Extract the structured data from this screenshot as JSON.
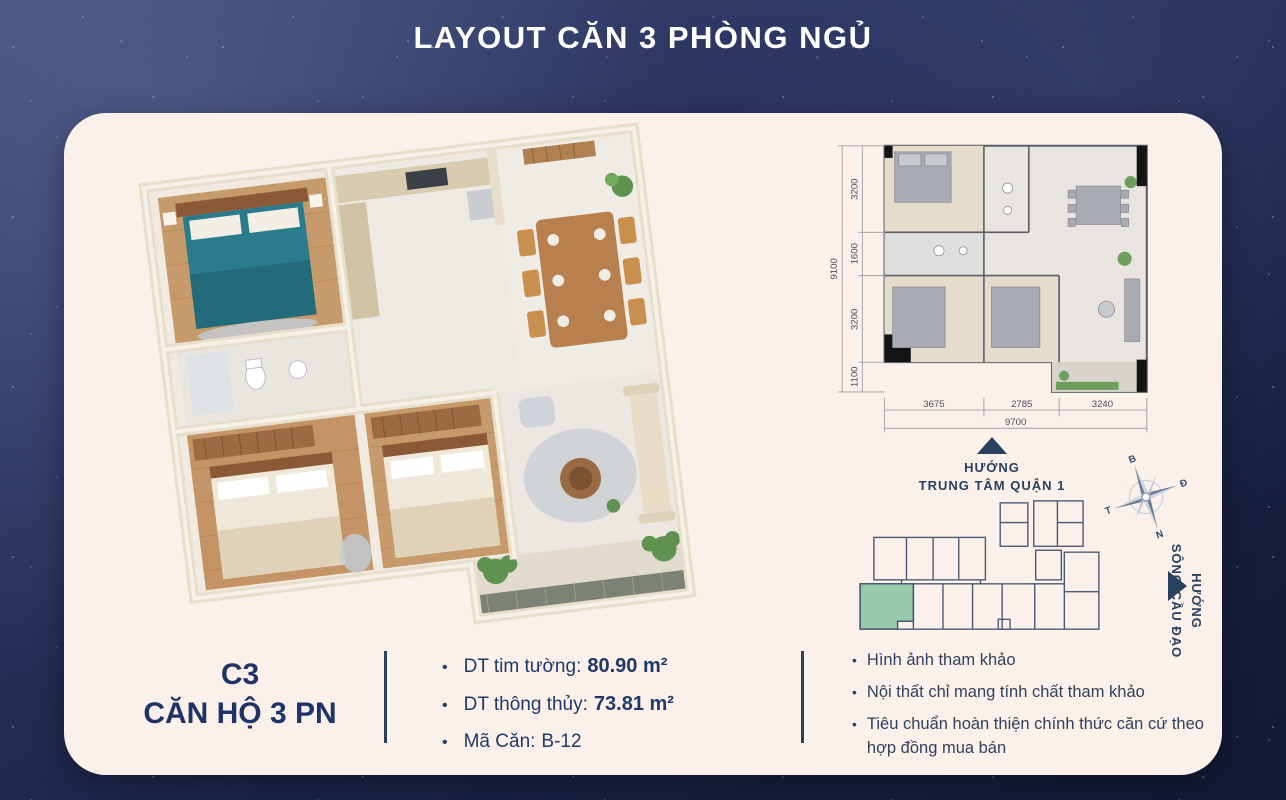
{
  "title": "LAYOUT CĂN 3 PHÒNG NGỦ",
  "unit": {
    "code": "C3",
    "name": "CĂN HỘ 3 PN"
  },
  "specs": [
    {
      "label": "DT tim tường:",
      "value": "80.90 m²"
    },
    {
      "label": "DT thông thủy:",
      "value": "73.81 m²"
    },
    {
      "label": "Mã Căn:",
      "value": "B-12"
    }
  ],
  "notes": [
    "Hình ảnh tham khảo",
    "Nội thất chỉ mang tính chất tham khảo",
    "Tiêu chuẩn hoàn thiện chính thức căn cứ theo hợp đồng mua bán"
  ],
  "directions": {
    "city": {
      "line1": "HƯỚNG",
      "line2": "TRUNG TÂM QUẬN 1"
    },
    "river": {
      "line1": "HƯỚNG",
      "line2": "SÔNG CẦU ĐẠO"
    }
  },
  "compass": {
    "n": "B",
    "e": "Đ",
    "s": "N",
    "w": "T"
  },
  "floorplan_2d": {
    "left_dims": [
      "3200",
      "1600",
      "3200",
      "1100"
    ],
    "left_total": "9100",
    "bottom_dims": [
      "3675",
      "2785",
      "3240"
    ],
    "bottom_total": "9700"
  },
  "colors": {
    "navy": "#1e3468",
    "card_bg": "#fbf0ea",
    "highlight_unit": "#97c9ac",
    "teal_bed": "#2a7b8c"
  }
}
